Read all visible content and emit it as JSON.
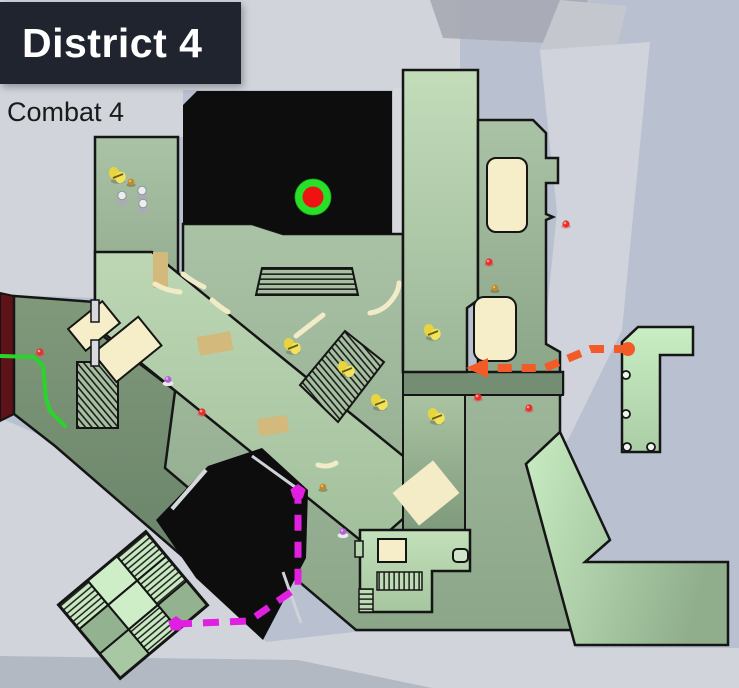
{
  "header": {
    "district_label": "District 4",
    "combat_label": "Combat 4"
  },
  "map": {
    "objective_marker": {
      "x": 313,
      "y": 197,
      "outer_radius": 18.5,
      "inner_radius": 10.5
    },
    "routes": {
      "orange": {
        "color": "#f25b28",
        "points": [
          [
            628,
            349
          ],
          [
            591,
            349
          ],
          [
            545,
            368
          ],
          [
            492,
            368
          ]
        ],
        "start_dot": [
          628,
          349
        ],
        "arrow_points": "466,368 488,358 488,378"
      },
      "magenta": {
        "color": "#e11fe1",
        "points": [
          [
            176,
            624
          ],
          [
            249,
            621
          ],
          [
            298,
            587
          ],
          [
            298,
            494
          ]
        ],
        "endpoint_dots": [
          [
            176,
            624
          ],
          [
            298,
            492
          ]
        ]
      },
      "green": {
        "color": "#2bd42b",
        "points": [
          [
            0,
            356
          ],
          [
            34,
            357
          ],
          [
            43,
            366
          ],
          [
            46,
            398
          ],
          [
            50,
            411
          ],
          [
            66,
            427
          ]
        ]
      }
    },
    "items": {
      "yellow_pickups": [
        [
          118,
          176
        ],
        [
          293,
          347
        ],
        [
          347,
          370
        ],
        [
          380,
          403
        ],
        [
          433,
          333
        ],
        [
          437,
          417
        ]
      ],
      "white_figures": [
        [
          122,
          198
        ],
        [
          142,
          193
        ],
        [
          143,
          206
        ]
      ],
      "red_markers": [
        [
          40,
          352
        ],
        [
          202,
          412
        ],
        [
          489,
          262
        ],
        [
          478,
          397
        ],
        [
          529,
          408
        ],
        [
          566,
          224
        ]
      ],
      "purple_pickups": [
        [
          168,
          380
        ],
        [
          343,
          532
        ]
      ],
      "gold_pickups": [
        [
          131,
          182
        ],
        [
          495,
          288
        ],
        [
          323,
          487
        ]
      ]
    },
    "palette": {
      "background": "#b9c1d0",
      "street": "#d1d4db",
      "floor_sage": "#9eb89a",
      "floor_light": "#b7d2af",
      "floor_mint": "#c6ebc1",
      "building_black": "#0d0d0d",
      "building_maroon": "#5c1216",
      "furniture_cream": "#f6eec9",
      "crate_tan": "#d3b97b",
      "route_orange": "#f25b28",
      "route_magenta": "#e11fe1",
      "route_green": "#2bd42b",
      "objective_outer": "#27e027",
      "objective_inner": "#ee1212"
    }
  }
}
